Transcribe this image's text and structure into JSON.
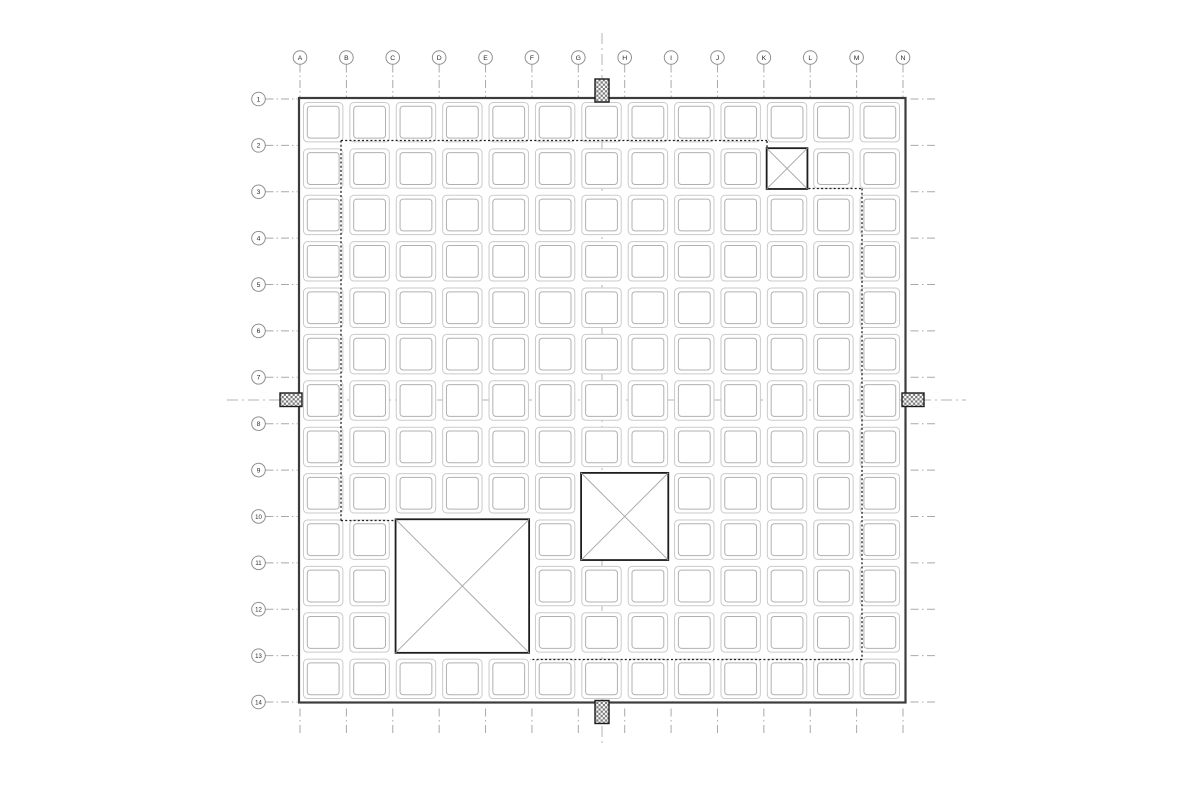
{
  "page": {
    "background": "#ffffff"
  },
  "drawing": {
    "name": "waffle-slab-framing-plan",
    "colors": {
      "slab_outline": "#3c3c3c",
      "cell_outer": "#cacaca",
      "cell_inner": "#b0b0b0",
      "gridline": "#a9a9a9",
      "centerline": "#b3b3b3",
      "boundary": "#1e1e1e",
      "opening_outline": "#1e1e1e",
      "opening_diagonal": "#a5a5a5",
      "bubble_stroke": "#8f8f8f",
      "bubble_text": "#2b2b2b",
      "hatch_dark": "#787878",
      "hatch_light": "#ffffff"
    },
    "grid": {
      "column_labels": [
        "A",
        "B",
        "C",
        "D",
        "E",
        "F",
        "G",
        "H",
        "I",
        "J",
        "K",
        "L",
        "M",
        "N"
      ],
      "row_labels": [
        "1",
        "2",
        "3",
        "4",
        "5",
        "6",
        "7",
        "8",
        "9",
        "10",
        "11",
        "12",
        "13",
        "14"
      ],
      "col_origin_x": 300,
      "row_origin_y": 99,
      "pitch": 46.385,
      "column_bubble_y": 57.5,
      "row_bubble_x": 258.5,
      "bubble_radius": 6.8,
      "column_leader": {
        "y1": 64.5,
        "y2": 97
      },
      "row_leader": {
        "x1": 265.5,
        "x2": 297.5
      },
      "right_extension": {
        "x1": 910.5,
        "x2": 937
      },
      "bottom_extension": {
        "y1": 708.5,
        "y2": 736
      }
    },
    "slab": {
      "x": 299,
      "y": 98,
      "w": 606.5,
      "h": 604.5
    },
    "cells": {
      "inset": 3.5,
      "size": 39.4,
      "inner_offset": 3.8,
      "outer_radius": 4,
      "inner_radius": 3
    },
    "opening_inset": 2.8,
    "openings": [
      {
        "id": "small",
        "bays": {
          "cols": [
            10
          ],
          "rows": [
            1
          ]
        }
      },
      {
        "id": "medium",
        "bays": {
          "cols": [
            6,
            7
          ],
          "rows": [
            8,
            9
          ]
        }
      },
      {
        "id": "large",
        "bays": {
          "cols": [
            2,
            3,
            4
          ],
          "rows": [
            9,
            10,
            11
          ]
        }
      }
    ],
    "dashed_boundary": {
      "segments": [
        [
          341,
          140.5,
          767,
          140.5
        ],
        [
          767,
          141,
          767,
          147.5
        ],
        [
          341,
          140.5,
          341,
          520.5
        ],
        [
          341,
          520.5,
          395,
          520.5
        ],
        [
          808.5,
          188.5,
          862,
          188.5
        ],
        [
          862,
          188.5,
          862,
          659.5
        ],
        [
          862,
          659.5,
          530,
          659.5
        ]
      ]
    },
    "centerlines": {
      "vertical": {
        "x": 602,
        "y1": 33,
        "y2": 746
      },
      "horizontal": {
        "y": 400,
        "x1": 227,
        "x2": 966
      }
    },
    "section_markers": [
      {
        "side": "top",
        "x": 595,
        "y": 79,
        "w": 14,
        "h": 23
      },
      {
        "side": "bottom",
        "x": 595,
        "y": 700.5,
        "w": 14,
        "h": 23
      },
      {
        "side": "left",
        "x": 280,
        "y": 393,
        "w": 22,
        "h": 13.5
      },
      {
        "side": "right",
        "x": 902,
        "y": 393,
        "w": 22,
        "h": 13.5
      }
    ]
  }
}
